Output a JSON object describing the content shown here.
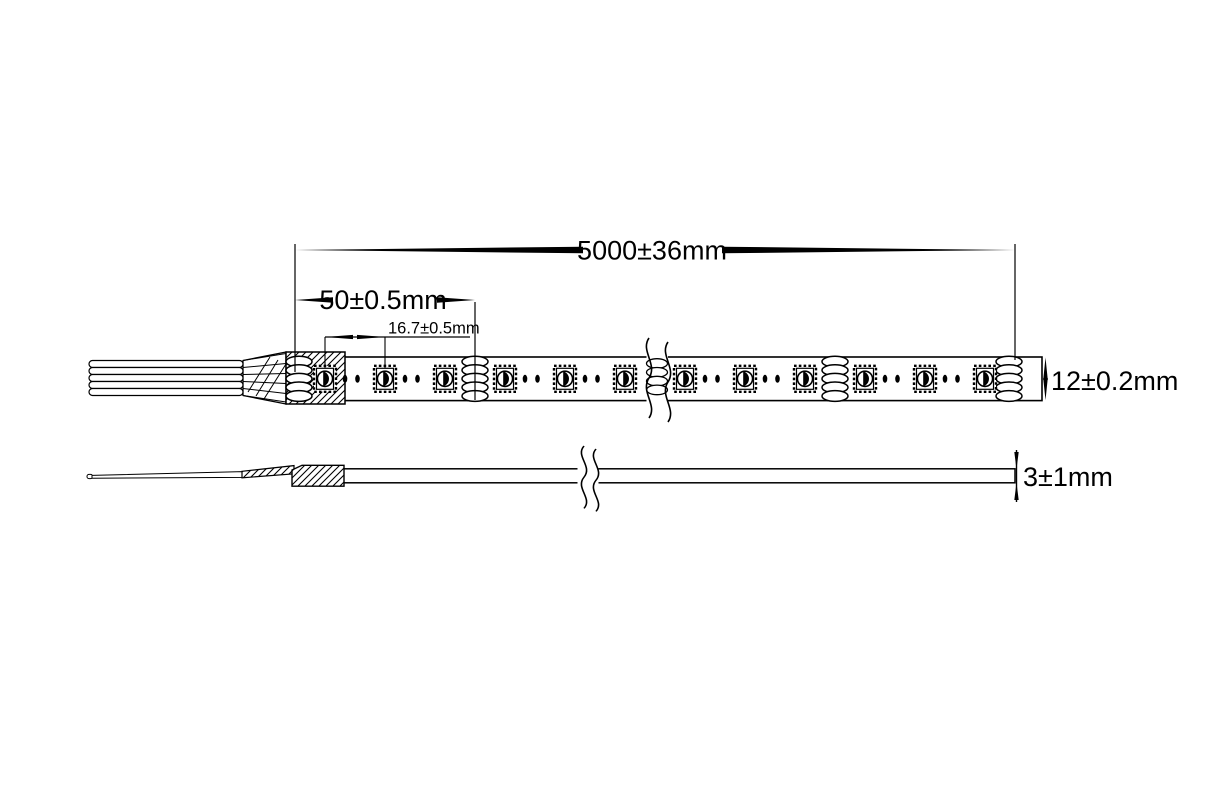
{
  "drawing": {
    "background": "#ffffff",
    "line_color": "#000000",
    "labels": {
      "overall_length": "5000±36mm",
      "cut_increment": "50±0.5mm",
      "led_pitch": "16.7±0.5mm",
      "strip_width": "12±0.2mm",
      "strip_thickness": "3±1mm"
    }
  }
}
